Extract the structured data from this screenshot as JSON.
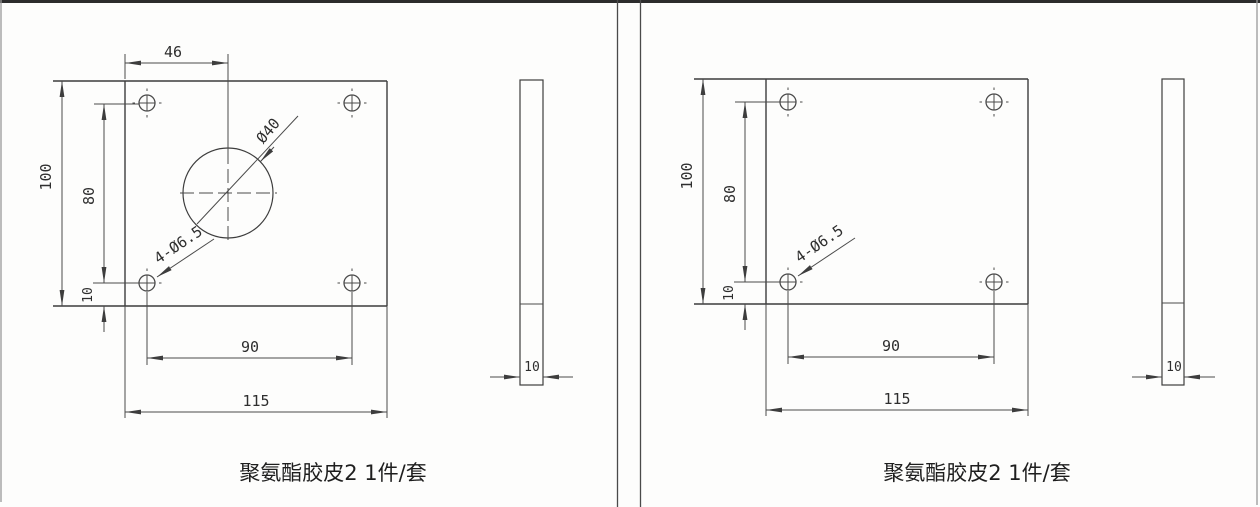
{
  "document": {
    "type": "engineering-drawing-scan",
    "background": "#fdfdfc",
    "line_color": "#3d3d3d",
    "frame_color": "#2c2c2c"
  },
  "left": {
    "caption": "聚氨酯胶皮2 1件/套",
    "front_view": {
      "dim_top_offset": "46",
      "dim_height": "100",
      "dim_hole_spacing_v": "80",
      "dim_edge_offset": "10",
      "dim_hole_spacing_h": "90",
      "dim_width": "115",
      "label_center_hole": "Ø40",
      "label_corner_holes": "4-Ø6.5"
    },
    "side_view": {
      "dim_thickness": "10"
    }
  },
  "right": {
    "caption": "聚氨酯胶皮2 1件/套",
    "front_view": {
      "dim_height": "100",
      "dim_hole_spacing_v": "80",
      "dim_edge_offset": "10",
      "dim_hole_spacing_h": "90",
      "dim_width": "115",
      "label_corner_holes": "4-Ø6.5"
    },
    "side_view": {
      "dim_thickness": "10"
    }
  }
}
